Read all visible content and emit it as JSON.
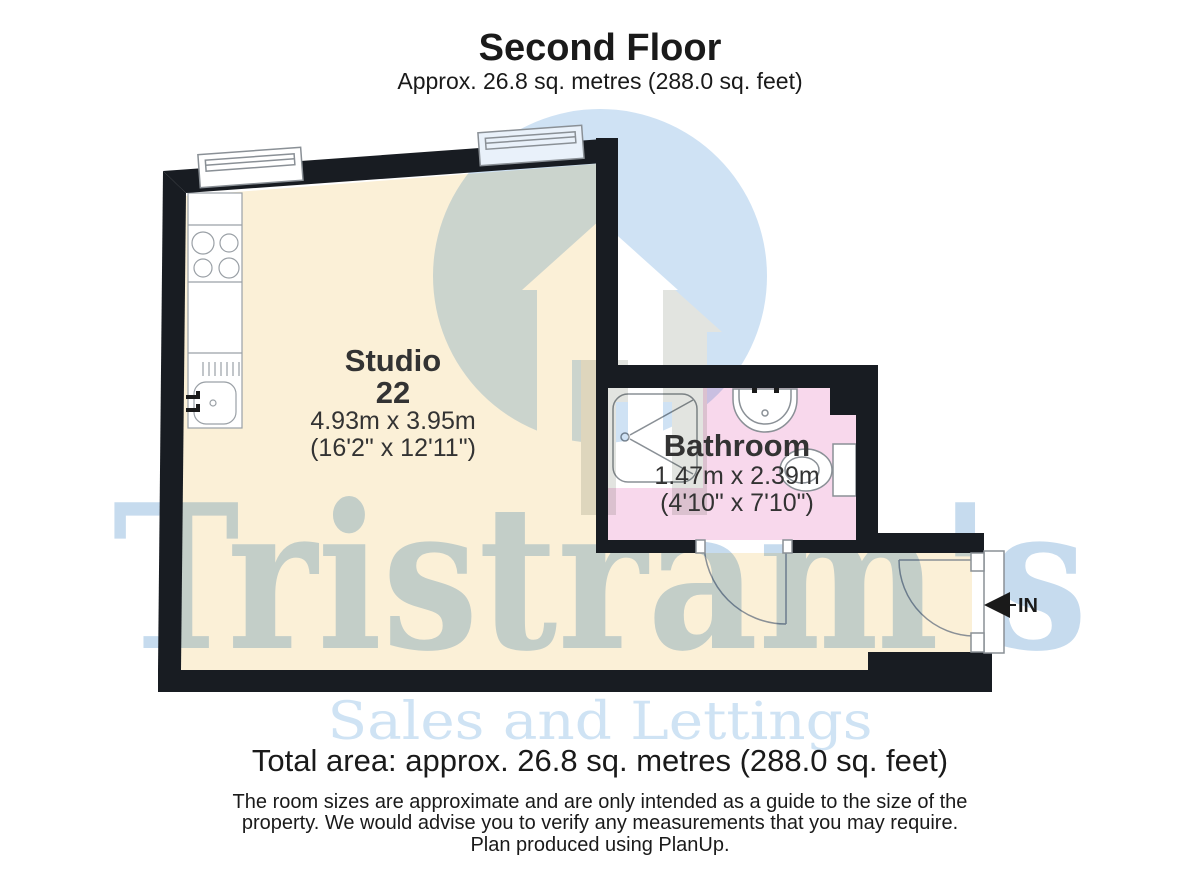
{
  "header": {
    "title": "Second Floor",
    "subtitle": "Approx. 26.8 sq. metres (288.0 sq. feet)"
  },
  "plan": {
    "studio": {
      "name": "Studio",
      "unit_number": "22",
      "size_metric": "4.93m x 3.95m",
      "size_imperial": "(16'2\" x 12'11\")"
    },
    "bathroom": {
      "name": "Bathroom",
      "size_metric": "1.47m x 2.39m",
      "size_imperial": "(4'10\" x 7'10\")"
    },
    "entrance_label": "IN"
  },
  "watermark": {
    "brand": "Tristram's",
    "tagline": "Sales and Lettings"
  },
  "footer": {
    "total_area": "Total area: approx. 26.8 sq. metres (288.0 sq. feet)",
    "disclaimer": [
      "The room sizes are approximate and are only intended as a guide to the size of the",
      "property. We would advise you to verify any measurements that you may require.",
      "Plan produced using PlanUp."
    ]
  },
  "colors": {
    "wall": "#181c22",
    "studio_floor": "#fbf0d7",
    "bathroom_floor": "#f8d8ec",
    "logo_circle_blue": "#cfe2f4",
    "logo_house_grey": "#e2e4e0",
    "brand_blue": "#c6dbee",
    "tagline_blue": "#cfe3f4"
  }
}
